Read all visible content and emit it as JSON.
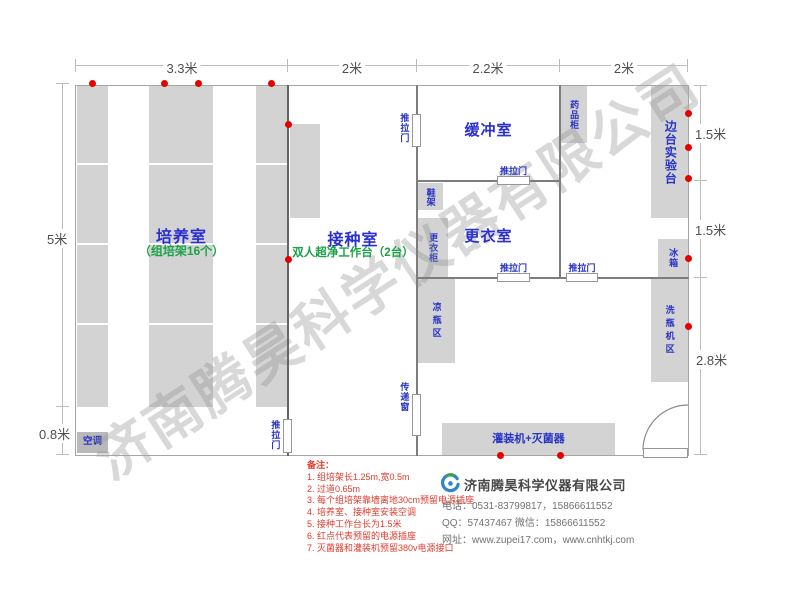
{
  "watermark": "济南腾昊科学仪器有限公司",
  "dimensions": {
    "top": [
      "3.3米",
      "2米",
      "2.2米",
      "2米"
    ],
    "left": [
      "5米",
      "0.8米"
    ],
    "right": [
      "1.5米",
      "1.5米",
      "2.8米"
    ]
  },
  "rooms": {
    "cultivation": {
      "name": "培养室",
      "sub": "（组培架16个）"
    },
    "inoculation": {
      "name": "接种室",
      "sub": "双人超净工作台（2台）"
    },
    "buffer": {
      "name": "缓冲室"
    },
    "changing": {
      "name": "更衣室"
    }
  },
  "fixtures": {
    "sliding_door": "推拉门",
    "pass_window": "传递窗",
    "shoe_rack": "鞋架",
    "locker": "更衣柜",
    "medicine_cabinet": "药品柜",
    "side_bench": "边台实验台",
    "fridge": "冰箱",
    "cool_bottle_area": "凉瓶区",
    "bottle_washer_area": "洗瓶机区",
    "filling_machine": "灌装机+灭菌器",
    "air_conditioner": "空调"
  },
  "notes": {
    "title": "备注：",
    "items": [
      "1. 组培架长1.25m,宽0.5m",
      "2. 过道0.65m",
      "3. 每个组培架靠墙离地30cm预留电源插座",
      "4. 培养室、接种室安装空调",
      "5. 接种工作台长为1.5米",
      "6. 红点代表预留的电源插座",
      "7. 灭菌器和灌装机预留380v电源接口"
    ]
  },
  "company": {
    "name": "济南腾昊科学仪器有限公司",
    "phone": "电话：0531-83799817，15866611552",
    "qq": "QQ：57437467    微信：15866611552",
    "website": "网址：www.zupei17.com，www.cnhtkj.com"
  },
  "colors": {
    "accent_blue": "#2a2fd0",
    "accent_green": "#19a347",
    "note_red": "#e23a2e",
    "socket_red": "#e60000"
  }
}
